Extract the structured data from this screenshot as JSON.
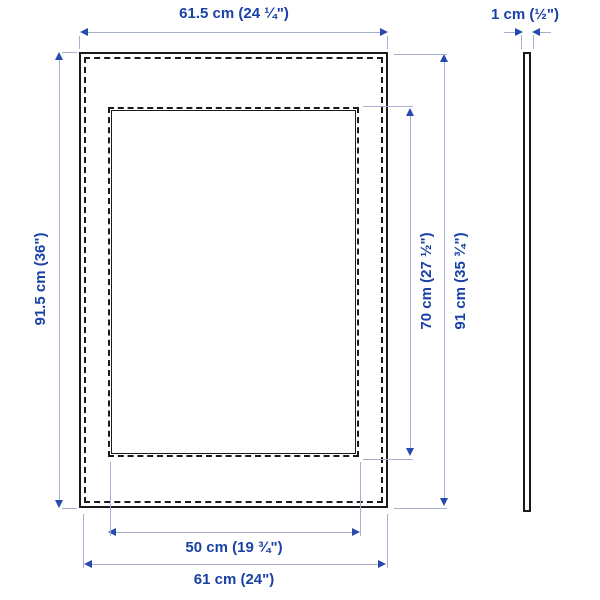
{
  "product_diagram": {
    "title": "picture frame dimension diagram",
    "views": {
      "front": {
        "labels": {
          "outer_width": "61.5 cm (24 ¼\")",
          "outer_height": "91.5 cm (36\")",
          "opening_width": "50 cm (19 ¾\")",
          "opening_height": "70 cm (27 ½\")",
          "frame_height": "91 cm (35 ¾\")",
          "frame_width": "61 cm (24\")"
        }
      },
      "side": {
        "labels": {
          "thickness": "1 cm (½\")"
        }
      }
    },
    "colors": {
      "dimension_text": "#1a41a5",
      "dimension_line": "#a8b0d0",
      "arrowhead": "#2a49ac",
      "outline": "#1a1a1a",
      "background": "#ffffff"
    }
  }
}
